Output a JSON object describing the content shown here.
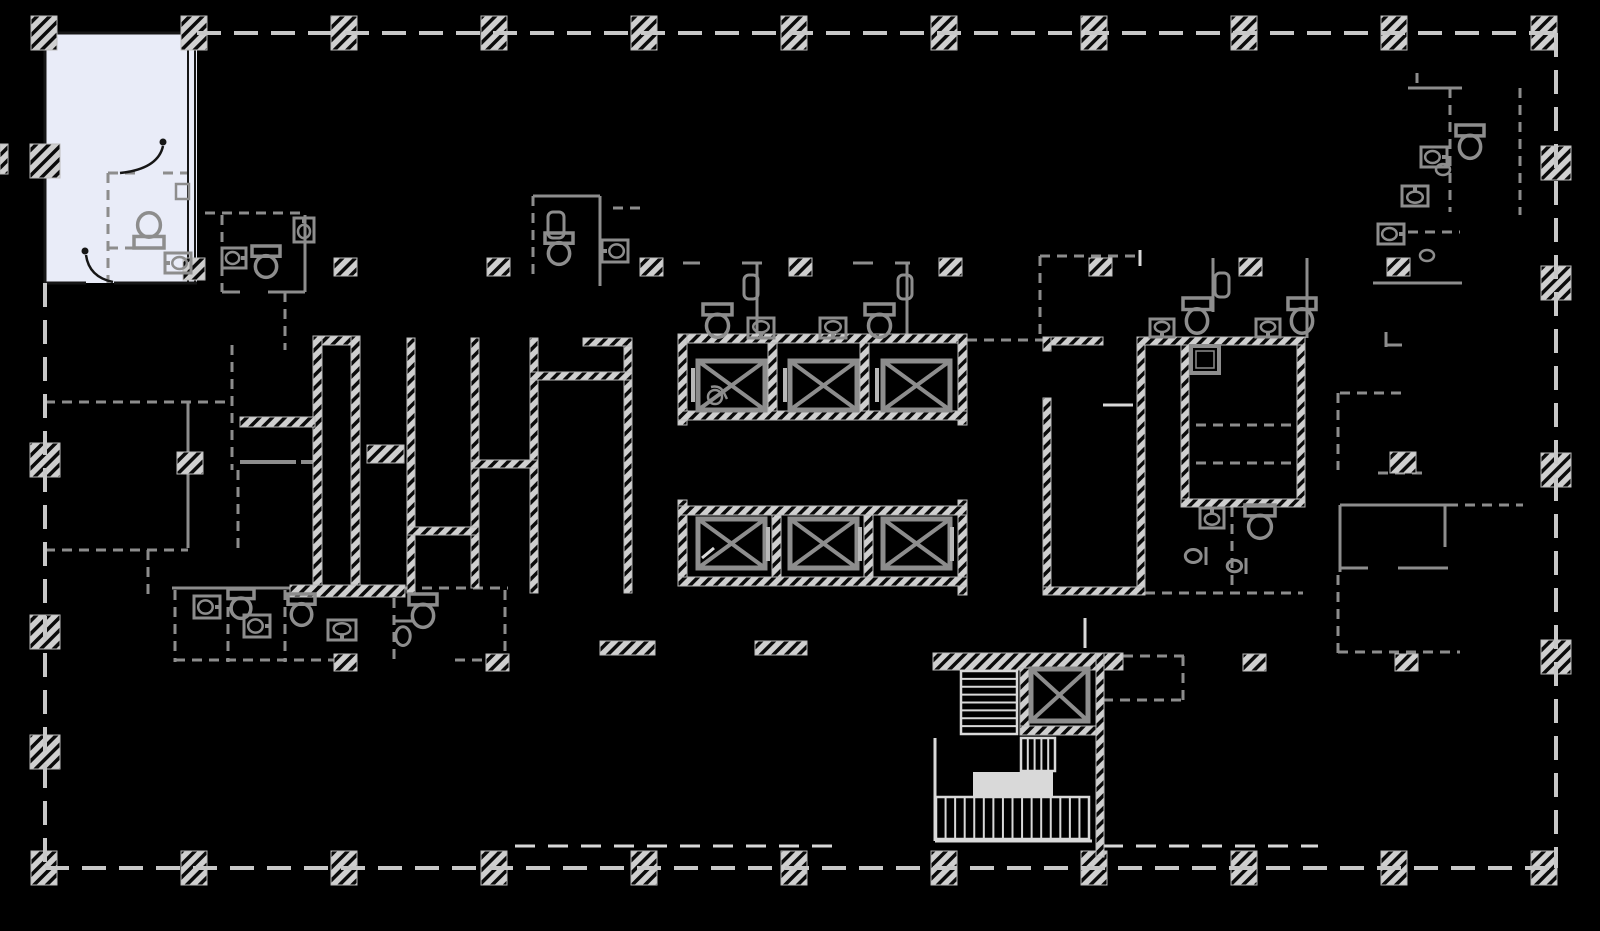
{
  "meta": {
    "title": "building-floor-plan",
    "canvas_w": 1600,
    "canvas_h": 931
  },
  "palette": {
    "bg": "#000000",
    "perimeter": "#c8c8c8",
    "wall_gray": "#8d8d8d",
    "wall_dark": "#161616",
    "light": "#d9d9d9",
    "door_bar": "#b8b8b8",
    "hatch_bg": "#cfcfcf",
    "hatch_stripe": "#0a0a0a",
    "highlight_fill": "#e9ecf8",
    "fixture": "#8d8d8d"
  },
  "plan": {
    "perimeter_segments": [
      [
        197,
        33,
        1556,
        33
      ],
      [
        1556,
        33,
        1556,
        868
      ],
      [
        45,
        868,
        1556,
        868
      ],
      [
        45,
        283,
        45,
        868
      ]
    ],
    "hatch_rects": [
      [
        31,
        16,
        26,
        34
      ],
      [
        181,
        16,
        26,
        34
      ],
      [
        331,
        16,
        26,
        34
      ],
      [
        481,
        16,
        26,
        34
      ],
      [
        631,
        16,
        26,
        34
      ],
      [
        781,
        16,
        26,
        34
      ],
      [
        931,
        16,
        26,
        34
      ],
      [
        1081,
        16,
        26,
        34
      ],
      [
        1231,
        16,
        26,
        34
      ],
      [
        1381,
        16,
        26,
        34
      ],
      [
        1531,
        16,
        26,
        34
      ],
      [
        31,
        851,
        26,
        34
      ],
      [
        181,
        851,
        26,
        34
      ],
      [
        331,
        851,
        26,
        34
      ],
      [
        481,
        851,
        26,
        34
      ],
      [
        631,
        851,
        26,
        34
      ],
      [
        781,
        851,
        26,
        34
      ],
      [
        931,
        851,
        26,
        34
      ],
      [
        1081,
        851,
        26,
        34
      ],
      [
        1231,
        851,
        26,
        34
      ],
      [
        1381,
        851,
        26,
        34
      ],
      [
        1531,
        851,
        26,
        34
      ],
      [
        30,
        144,
        30,
        34
      ],
      [
        30,
        443,
        30,
        34
      ],
      [
        30,
        615,
        30,
        34
      ],
      [
        30,
        735,
        30,
        34
      ],
      [
        1541,
        146,
        30,
        34
      ],
      [
        1541,
        266,
        30,
        34
      ],
      [
        1541,
        453,
        30,
        34
      ],
      [
        1541,
        640,
        30,
        34
      ],
      [
        0,
        144,
        8,
        30
      ],
      [
        183,
        258,
        22,
        22
      ],
      [
        334,
        258,
        23,
        18
      ],
      [
        487,
        258,
        23,
        18
      ],
      [
        640,
        258,
        23,
        18
      ],
      [
        789,
        258,
        23,
        18
      ],
      [
        939,
        258,
        23,
        18
      ],
      [
        1089,
        258,
        23,
        18
      ],
      [
        1239,
        258,
        23,
        18
      ],
      [
        1387,
        258,
        23,
        18
      ],
      [
        334,
        654,
        23,
        17
      ],
      [
        486,
        654,
        23,
        17
      ],
      [
        1243,
        654,
        23,
        17
      ],
      [
        1395,
        654,
        23,
        17
      ],
      [
        313,
        336,
        47,
        9
      ],
      [
        313,
        336,
        9,
        261
      ],
      [
        351,
        336,
        9,
        261
      ],
      [
        290,
        585,
        115,
        12
      ],
      [
        407,
        338,
        8,
        255
      ],
      [
        471,
        338,
        8,
        250
      ],
      [
        530,
        338,
        8,
        255
      ],
      [
        624,
        338,
        8,
        255
      ],
      [
        530,
        372,
        102,
        8
      ],
      [
        471,
        460,
        67,
        8
      ],
      [
        407,
        527,
        72,
        8
      ],
      [
        583,
        338,
        49,
        8
      ],
      [
        240,
        417,
        75,
        10
      ],
      [
        367,
        445,
        37,
        18
      ],
      [
        177,
        452,
        26,
        22
      ],
      [
        678,
        334,
        289,
        9
      ],
      [
        678,
        334,
        9,
        91
      ],
      [
        958,
        334,
        9,
        91
      ],
      [
        678,
        411,
        289,
        9
      ],
      [
        768,
        343,
        9,
        68
      ],
      [
        860,
        343,
        9,
        68
      ],
      [
        678,
        500,
        9,
        86
      ],
      [
        958,
        500,
        9,
        95
      ],
      [
        678,
        506,
        289,
        9
      ],
      [
        678,
        577,
        289,
        9
      ],
      [
        772,
        515,
        9,
        62
      ],
      [
        864,
        515,
        9,
        62
      ],
      [
        600,
        641,
        55,
        14
      ],
      [
        755,
        641,
        52,
        14
      ],
      [
        933,
        653,
        190,
        17
      ],
      [
        1020,
        668,
        9,
        67
      ],
      [
        1020,
        726,
        83,
        9
      ],
      [
        1096,
        653,
        8,
        204
      ],
      [
        1043,
        337,
        60,
        8
      ],
      [
        1043,
        337,
        8,
        14
      ],
      [
        1043,
        398,
        8,
        197
      ],
      [
        1137,
        337,
        8,
        258
      ],
      [
        1043,
        587,
        102,
        8
      ],
      [
        1137,
        337,
        168,
        8
      ],
      [
        1297,
        345,
        8,
        162
      ],
      [
        1181,
        345,
        8,
        162
      ],
      [
        1181,
        499,
        124,
        8
      ],
      [
        1390,
        452,
        26,
        21
      ]
    ],
    "gray_lines": [
      [
        205,
        213,
        305,
        213,
        3,
        1
      ],
      [
        222,
        215,
        222,
        292,
        3,
        1
      ],
      [
        305,
        215,
        305,
        292,
        3,
        0
      ],
      [
        222,
        292,
        240,
        292,
        3,
        0
      ],
      [
        268,
        292,
        305,
        292,
        3,
        0
      ],
      [
        285,
        292,
        285,
        350,
        3,
        1
      ],
      [
        533,
        196,
        533,
        278,
        3,
        1
      ],
      [
        533,
        196,
        600,
        196,
        3,
        0
      ],
      [
        600,
        196,
        600,
        286,
        3,
        0
      ],
      [
        613,
        208,
        640,
        208,
        3,
        1
      ],
      [
        683,
        263,
        700,
        263,
        3,
        0
      ],
      [
        742,
        263,
        762,
        263,
        3,
        0
      ],
      [
        757,
        263,
        757,
        340,
        3,
        0
      ],
      [
        853,
        263,
        873,
        263,
        3,
        0
      ],
      [
        895,
        263,
        910,
        263,
        3,
        0
      ],
      [
        907,
        263,
        907,
        340,
        3,
        0
      ],
      [
        967,
        340,
        1043,
        340,
        3,
        1
      ],
      [
        1040,
        256,
        1040,
        340,
        3,
        1
      ],
      [
        1040,
        256,
        1140,
        256,
        3,
        1
      ],
      [
        1213,
        258,
        1213,
        312,
        3,
        0
      ],
      [
        1307,
        258,
        1307,
        338,
        3,
        0
      ],
      [
        1232,
        507,
        1232,
        593,
        3,
        1
      ],
      [
        1145,
        593,
        1303,
        593,
        3,
        1
      ],
      [
        1196,
        425,
        1300,
        425,
        3,
        1
      ],
      [
        1196,
        463,
        1300,
        463,
        3,
        1
      ],
      [
        1340,
        505,
        1448,
        505,
        3,
        0
      ],
      [
        1340,
        505,
        1340,
        572,
        3,
        0
      ],
      [
        1445,
        505,
        1445,
        547,
        3,
        0
      ],
      [
        1340,
        568,
        1368,
        568,
        3,
        0
      ],
      [
        1398,
        568,
        1448,
        568,
        3,
        0
      ],
      [
        1448,
        505,
        1523,
        505,
        3,
        1
      ],
      [
        1338,
        575,
        1338,
        655,
        3,
        1
      ],
      [
        1338,
        652,
        1460,
        652,
        3,
        1
      ],
      [
        1340,
        393,
        1403,
        393,
        3,
        1
      ],
      [
        1338,
        393,
        1338,
        470,
        3,
        1
      ],
      [
        1378,
        473,
        1425,
        473,
        3,
        1
      ],
      [
        1408,
        88,
        1462,
        88,
        3,
        0
      ],
      [
        1450,
        88,
        1450,
        212,
        3,
        1
      ],
      [
        1408,
        232,
        1460,
        232,
        3,
        1
      ],
      [
        1373,
        283,
        1462,
        283,
        3,
        0
      ],
      [
        1520,
        88,
        1520,
        215,
        3,
        1
      ],
      [
        1417,
        73,
        1417,
        90,
        3,
        1
      ],
      [
        1386,
        332,
        1386,
        347,
        3,
        0
      ],
      [
        1386,
        345,
        1402,
        345,
        3,
        0
      ],
      [
        45,
        402,
        230,
        402,
        3,
        1
      ],
      [
        188,
        402,
        188,
        548,
        3,
        0
      ],
      [
        45,
        550,
        188,
        550,
        3,
        1
      ],
      [
        148,
        550,
        148,
        595,
        3,
        1
      ],
      [
        232,
        345,
        232,
        470,
        3,
        1
      ],
      [
        238,
        470,
        238,
        555,
        3,
        1
      ],
      [
        240,
        462,
        296,
        462,
        4,
        0
      ],
      [
        301,
        462,
        313,
        462,
        4,
        0
      ],
      [
        172,
        588,
        290,
        588,
        3,
        0
      ],
      [
        405,
        588,
        508,
        588,
        3,
        1
      ],
      [
        175,
        590,
        175,
        662,
        3,
        1
      ],
      [
        228,
        590,
        228,
        662,
        3,
        1
      ],
      [
        285,
        590,
        285,
        662,
        3,
        1
      ],
      [
        394,
        598,
        394,
        662,
        3,
        1
      ],
      [
        505,
        590,
        505,
        662,
        3,
        1
      ],
      [
        175,
        660,
        345,
        660,
        3,
        1
      ],
      [
        455,
        660,
        505,
        660,
        3,
        1
      ],
      [
        1123,
        656,
        1185,
        656,
        3,
        1
      ],
      [
        1183,
        656,
        1183,
        703,
        3,
        1
      ],
      [
        1103,
        700,
        1183,
        700,
        3,
        1
      ],
      [
        1047,
        662,
        1086,
        662,
        3,
        0
      ],
      [
        108,
        173,
        140,
        173,
        3,
        1
      ],
      [
        163,
        173,
        188,
        173,
        3,
        1
      ],
      [
        108,
        173,
        108,
        283,
        3,
        1
      ],
      [
        108,
        248,
        135,
        248,
        3,
        1
      ]
    ],
    "dark_lines": [
      [
        45,
        33,
        197,
        33,
        3
      ],
      [
        45,
        33,
        45,
        283,
        3
      ],
      [
        45,
        283,
        86,
        283,
        3
      ],
      [
        114,
        283,
        197,
        283,
        3
      ],
      [
        188,
        33,
        188,
        283,
        2
      ],
      [
        195,
        33,
        195,
        283,
        2
      ]
    ],
    "light_lines": [
      [
        515,
        846,
        845,
        846,
        3,
        1
      ],
      [
        1103,
        846,
        1318,
        846,
        3,
        1
      ],
      [
        1103,
        405,
        1133,
        405,
        3,
        0
      ],
      [
        1140,
        250,
        1140,
        266,
        3,
        0
      ],
      [
        1085,
        618,
        1085,
        648,
        3,
        0
      ],
      [
        702,
        558,
        714,
        548,
        3,
        0
      ],
      [
        935,
        738,
        935,
        841,
        3,
        0
      ],
      [
        935,
        841,
        1092,
        841,
        3,
        0
      ]
    ],
    "highlight_unit": {
      "rect": [
        45,
        33,
        152,
        250
      ],
      "door_arcs": [
        "M163,146 Q158,169 120,173",
        "M86,255 Q89,277 113,282"
      ],
      "hinge_dots": [
        [
          163,
          142
        ],
        [
          85,
          251
        ]
      ]
    },
    "elevator_cabs": [
      [
        698,
        361,
        67,
        49
      ],
      [
        790,
        361,
        67,
        49
      ],
      [
        883,
        361,
        67,
        49
      ],
      [
        698,
        519,
        67,
        49
      ],
      [
        790,
        519,
        67,
        49
      ],
      [
        883,
        519,
        67,
        49
      ],
      [
        1031,
        669,
        57,
        52
      ]
    ],
    "door_bars": [
      [
        691,
        368
      ],
      [
        783,
        368
      ],
      [
        875,
        368
      ],
      [
        766,
        527
      ],
      [
        858,
        527
      ],
      [
        950,
        527
      ]
    ],
    "stairs": {
      "flights": [
        {
          "x": 961,
          "y": 671,
          "w": 56,
          "h": 63,
          "n": 8,
          "dir": "h"
        },
        {
          "x": 1021,
          "y": 738,
          "w": 34,
          "h": 33,
          "n": 5,
          "dir": "v"
        },
        {
          "x": 936,
          "y": 797,
          "w": 153,
          "h": 42,
          "n": 16,
          "dir": "v"
        }
      ],
      "landing": [
        973,
        772,
        80,
        25
      ]
    },
    "fixtures": [
      [
        "toilet",
        134,
        212,
        30,
        36,
        180
      ],
      [
        "toilet",
        252,
        246,
        28,
        32,
        0
      ],
      [
        "toilet",
        545,
        233,
        28,
        32,
        0
      ],
      [
        "toilet",
        703,
        304,
        29,
        34,
        0
      ],
      [
        "toilet",
        865,
        304,
        29,
        34,
        0
      ],
      [
        "toilet",
        1183,
        298,
        28,
        36,
        0
      ],
      [
        "toilet",
        1288,
        298,
        28,
        36,
        0
      ],
      [
        "toilet",
        1456,
        125,
        28,
        34,
        0
      ],
      [
        "toilet",
        1245,
        505,
        30,
        34,
        0
      ],
      [
        "toilet",
        228,
        589,
        26,
        30,
        0
      ],
      [
        "toilet",
        288,
        594,
        27,
        32,
        0
      ],
      [
        "toilet",
        409,
        594,
        28,
        34,
        0
      ],
      [
        "sink",
        168,
        250,
        20,
        26,
        270
      ],
      [
        "sink",
        224,
        246,
        20,
        24,
        90
      ],
      [
        "sink",
        294,
        218,
        20,
        24,
        0
      ],
      [
        "sink",
        604,
        238,
        22,
        26,
        270
      ],
      [
        "sink",
        748,
        318,
        26,
        20,
        180
      ],
      [
        "sink",
        820,
        318,
        26,
        20,
        180
      ],
      [
        "sink",
        1150,
        319,
        24,
        18,
        180
      ],
      [
        "sink",
        1256,
        319,
        24,
        18,
        180
      ],
      [
        "sink",
        1424,
        144,
        20,
        26,
        90
      ],
      [
        "sink",
        1402,
        186,
        26,
        20,
        0
      ],
      [
        "sink",
        1381,
        221,
        20,
        26,
        90
      ],
      [
        "sink",
        196,
        594,
        22,
        26,
        90
      ],
      [
        "sink",
        246,
        613,
        22,
        26,
        90
      ],
      [
        "sink",
        328,
        620,
        28,
        20,
        180
      ],
      [
        "sink",
        1200,
        508,
        24,
        20,
        0
      ],
      [
        "oval",
        1436,
        164,
        14,
        11,
        0
      ],
      [
        "oval",
        1420,
        250,
        14,
        11,
        0
      ],
      [
        "urinal",
        1186,
        545,
        18,
        22,
        90
      ],
      [
        "urinal",
        1228,
        556,
        16,
        20,
        90
      ],
      [
        "urinal",
        393,
        621,
        20,
        26,
        0
      ],
      [
        "box",
        176,
        184,
        13,
        15,
        0
      ],
      [
        "cistern",
        548,
        212,
        16,
        26,
        0
      ],
      [
        "cistern",
        744,
        275,
        14,
        24,
        0
      ],
      [
        "cistern",
        898,
        275,
        14,
        24,
        0
      ],
      [
        "cistern",
        1215,
        273,
        14,
        24,
        0
      ],
      [
        "shower",
        1191,
        346,
        28,
        27,
        0
      ],
      [
        "wheelchair",
        706,
        384,
        22,
        22,
        0
      ]
    ]
  }
}
